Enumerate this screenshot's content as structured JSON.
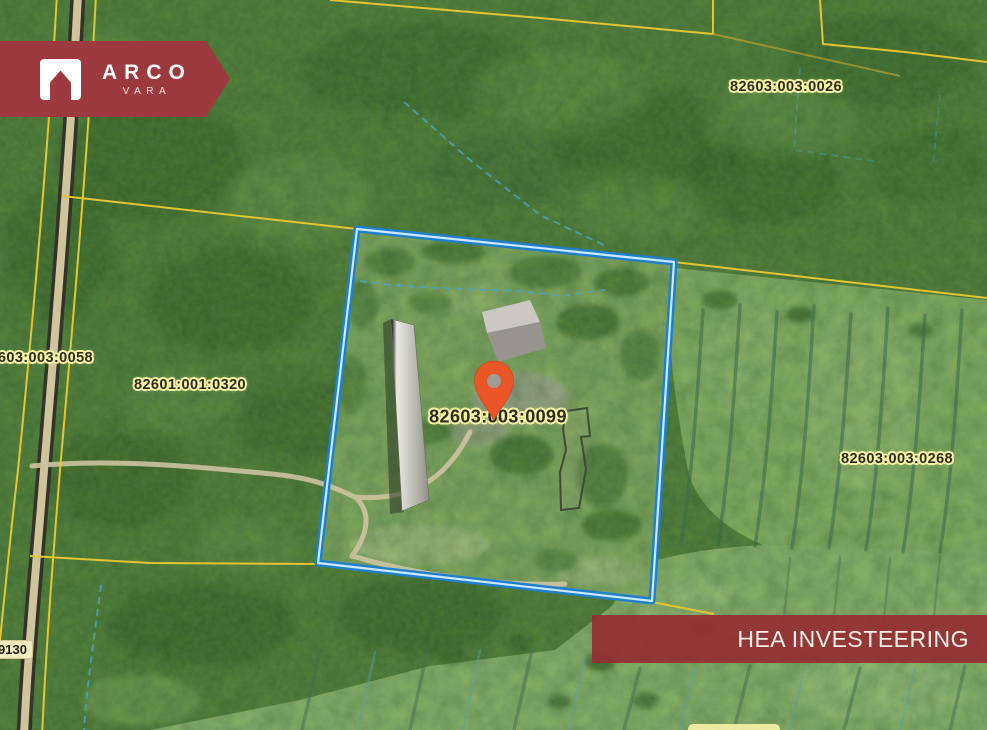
{
  "brand": {
    "name": "ARCO",
    "tagline": "VARA"
  },
  "listing_banner": {
    "label": "HEA INVESTEERING"
  },
  "map": {
    "parcel_labels": [
      {
        "text": "82603:003:0026"
      },
      {
        "text": "82603:003:0058"
      },
      {
        "text": "82601:001:0320"
      },
      {
        "text": "82603:003:0099"
      },
      {
        "text": "82603:003:0268"
      }
    ],
    "road_label": {
      "text": "9130"
    },
    "colors": {
      "brand_maroon": "#9d3a3f",
      "parcel_outline_blue": "#1d7fd0",
      "pin_orange": "#ea5627",
      "cadastral_yellow": "#e4c431",
      "label_halo": "#f8f2a6"
    }
  }
}
